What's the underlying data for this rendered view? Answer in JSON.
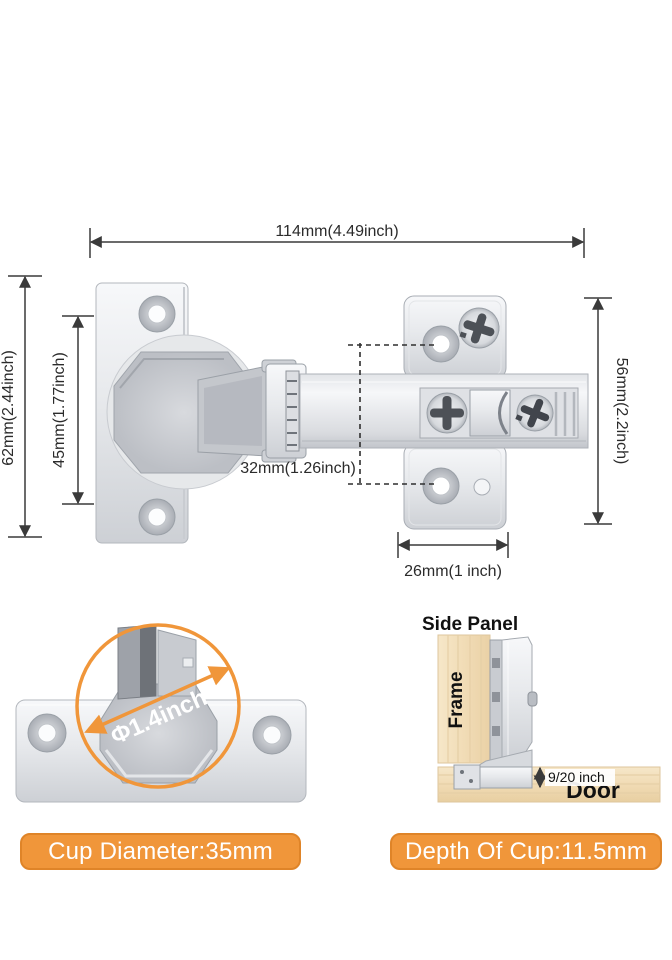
{
  "dimensions": {
    "total_width": "114mm(4.49inch)",
    "door_plate_height": "62mm(2.44inch)",
    "door_plate_hole_span": "45mm(1.77inch)",
    "mount_hole_spacing": "32mm(1.26inch)",
    "mount_plate_height": "56mm(2.2inch)",
    "mount_plate_width": "26mm(1 inch)",
    "cup_diameter_inch": "Φ1.4inch",
    "cup_overlay_depth": "9/20 inch"
  },
  "installation": {
    "side_panel_label": "Side Panel",
    "frame_label": "Frame",
    "door_label": "Door"
  },
  "badges": {
    "cup_diameter": "Cup Diameter:35mm",
    "cup_depth": "Depth Of Cup:11.5mm"
  },
  "colors": {
    "accent_orange": "#F0963A",
    "dimension_line": "#3A3A3A",
    "wood_light": "#F4E3C4",
    "metal_light": "#F2F3F5",
    "metal_shadow": "#C7CACF",
    "text": "#2B2B2B",
    "badge_text": "#FFFFFF"
  }
}
